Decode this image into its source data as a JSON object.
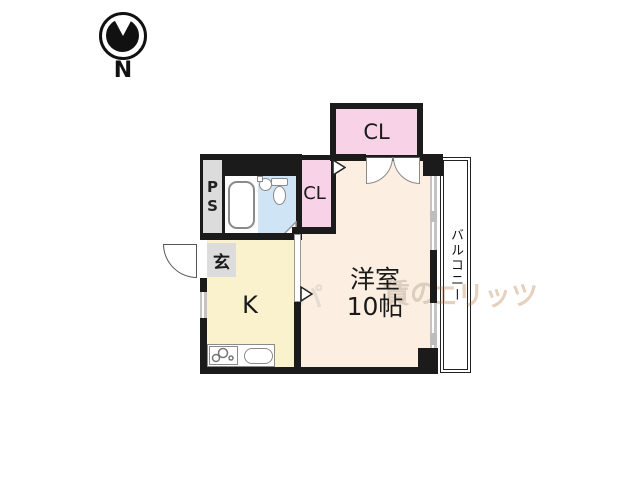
{
  "compass": {
    "label": "N"
  },
  "floorplan": {
    "closet_top_label": "CL",
    "closet_small_label": "CL",
    "pipe_space_label": "PS",
    "entrance_label": "玄",
    "kitchen_label": "K",
    "main_room_name": "洋室",
    "main_room_size": "10帖",
    "balcony_label": "バルコニー"
  },
  "watermark": {
    "left_fragment": "パ",
    "mid_fragment": "賃の",
    "right_fragment": "エリッツ"
  },
  "colors": {
    "wall": "#1b1b1b",
    "room": "#fcefe2",
    "kitchen": "#faf2cc",
    "closet": "#f8d3e7",
    "bath": "#cfe4f5",
    "graybox": "#dcdcdc",
    "window": "#c4c4c4"
  }
}
